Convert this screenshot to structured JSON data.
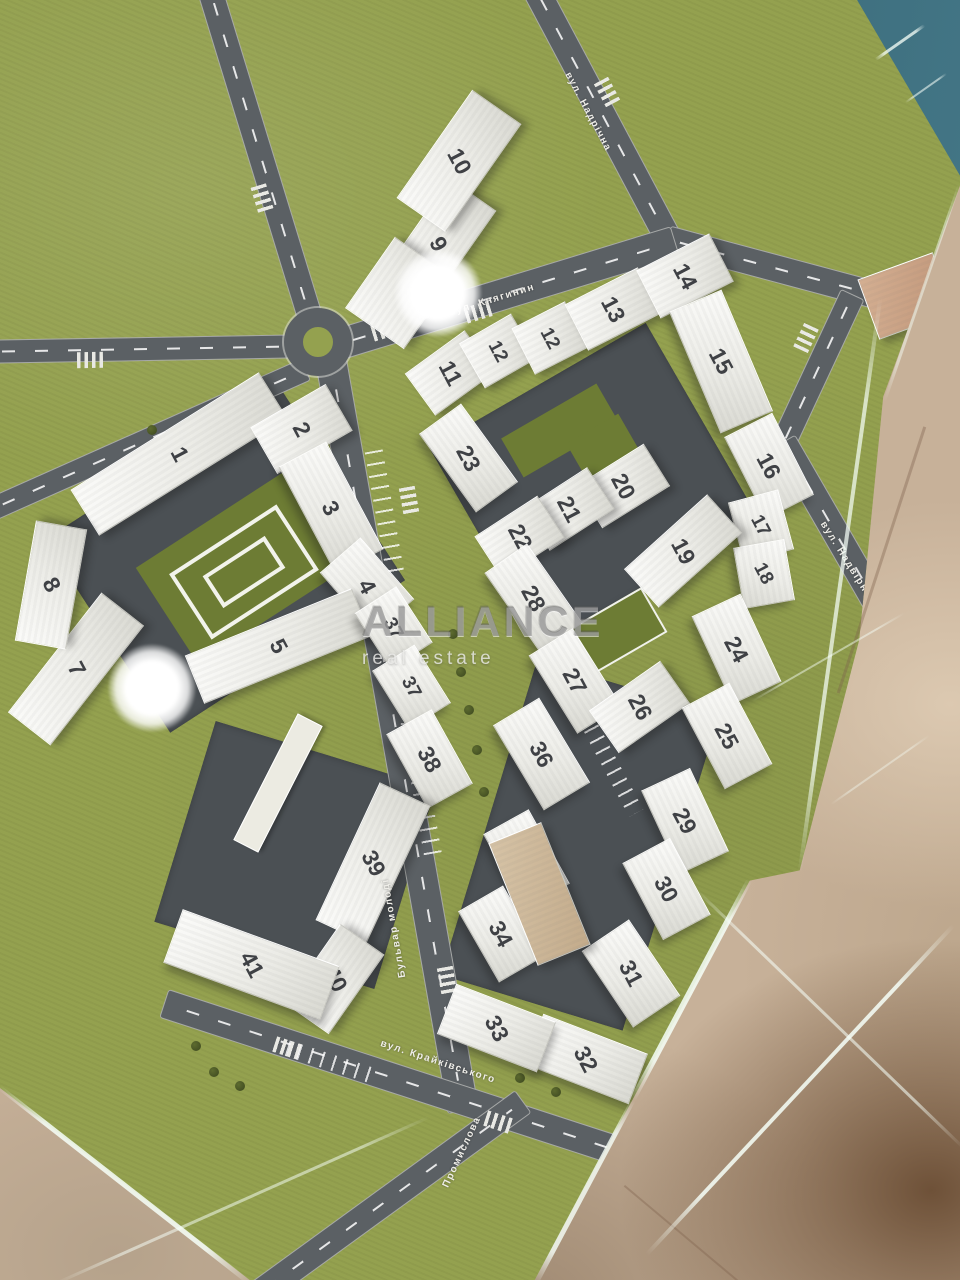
{
  "watermark": {
    "line1": "ALLIANCE",
    "line2": "real estate"
  },
  "colors": {
    "grass": "#94a14f",
    "road": "#5b6064",
    "courtyard": "#4b5054",
    "water": "#33616f",
    "marble": "#c7b199",
    "roof_green": "#6d7c34",
    "building": "#f2f1ec",
    "number": "#3f4145"
  },
  "streets": [
    {
      "name": "вул. Надрічна",
      "x": 588,
      "y": 112,
      "rot": 62
    },
    {
      "name": "вул. Княгинин",
      "x": 492,
      "y": 300,
      "rot": -17
    },
    {
      "name": "вул. Надвірна",
      "x": 846,
      "y": 560,
      "rot": 58
    },
    {
      "name": "Бульвар молоді",
      "x": 394,
      "y": 928,
      "rot": -100
    },
    {
      "name": "вул. Крайківського",
      "x": 438,
      "y": 1062,
      "rot": 18
    },
    {
      "name": "Промислова",
      "x": 462,
      "y": 1152,
      "rot": -65
    }
  ],
  "courts": [
    {
      "x": 225,
      "y": 560,
      "w": 280,
      "h": 230,
      "r": -33
    },
    {
      "x": 295,
      "y": 855,
      "w": 230,
      "h": 210,
      "r": 17
    },
    {
      "x": 595,
      "y": 485,
      "w": 250,
      "h": 230,
      "r": -30
    },
    {
      "x": 580,
      "y": 845,
      "w": 190,
      "h": 330,
      "r": 17
    }
  ],
  "roads": [
    {
      "x": 601,
      "y": 114,
      "len": 285,
      "w": 26,
      "rot": 62
    },
    {
      "x": 814,
      "y": 278,
      "len": 305,
      "w": 26,
      "rot": 15
    },
    {
      "x": 506,
      "y": 292,
      "len": 350,
      "w": 30,
      "rot": -17
    },
    {
      "x": 260,
      "y": 156,
      "len": 350,
      "w": 24,
      "rot": 73
    },
    {
      "x": 145,
      "y": 348,
      "len": 312,
      "w": 22,
      "rot": -1
    },
    {
      "x": 146,
      "y": 439,
      "len": 345,
      "w": 22,
      "rot": -24
    },
    {
      "x": 396,
      "y": 734,
      "len": 762,
      "w": 30,
      "rot": 80
    },
    {
      "x": 432,
      "y": 1090,
      "len": 565,
      "w": 28,
      "rot": 18
    },
    {
      "x": 388,
      "y": 1198,
      "len": 330,
      "w": 26,
      "rot": -36
    },
    {
      "x": 816,
      "y": 369,
      "len": 165,
      "w": 24,
      "rot": -65
    },
    {
      "x": 859,
      "y": 574,
      "len": 306,
      "w": 26,
      "rot": 60
    }
  ],
  "crosswalks": [
    {
      "x": 607,
      "y": 92,
      "rot": 62
    },
    {
      "x": 478,
      "y": 312,
      "rot": -17
    },
    {
      "x": 385,
      "y": 330,
      "rot": -17
    },
    {
      "x": 262,
      "y": 198,
      "rot": 73
    },
    {
      "x": 409,
      "y": 500,
      "rot": 80
    },
    {
      "x": 447,
      "y": 980,
      "rot": 80
    },
    {
      "x": 498,
      "y": 1122,
      "rot": 18
    },
    {
      "x": 287,
      "y": 1048,
      "rot": 18
    },
    {
      "x": 806,
      "y": 338,
      "rot": -65
    },
    {
      "x": 90,
      "y": 360,
      "rot": -1
    }
  ],
  "parking": [
    {
      "x": 385,
      "y": 515,
      "len": 130,
      "w": 18,
      "rot": 80
    },
    {
      "x": 418,
      "y": 770,
      "len": 170,
      "w": 18,
      "rot": 80
    },
    {
      "x": 330,
      "y": 1062,
      "len": 90,
      "w": 16,
      "rot": 18
    },
    {
      "x": 608,
      "y": 760,
      "len": 120,
      "w": 16,
      "rot": 62
    }
  ],
  "features": [
    {
      "t": "green",
      "x": 240,
      "y": 568,
      "w": 175,
      "h": 115,
      "r": -33
    },
    {
      "t": "ring",
      "x": 240,
      "y": 568,
      "w": 120,
      "h": 70,
      "r": -33
    },
    {
      "t": "ring",
      "x": 240,
      "y": 568,
      "w": 66,
      "h": 30,
      "r": -33
    },
    {
      "t": "green",
      "x": 560,
      "y": 430,
      "w": 110,
      "h": 45,
      "r": -30
    },
    {
      "t": "green",
      "x": 606,
      "y": 452,
      "w": 60,
      "h": 55,
      "r": -30
    },
    {
      "t": "green",
      "x": 617,
      "y": 628,
      "w": 78,
      "h": 48,
      "r": -30,
      "b": 1
    },
    {
      "t": "white",
      "x": 277,
      "y": 782,
      "w": 140,
      "h": 26,
      "r": -63
    }
  ],
  "trees": [
    [
      453,
      634
    ],
    [
      461,
      672
    ],
    [
      469,
      710
    ],
    [
      477,
      750
    ],
    [
      484,
      792
    ],
    [
      300,
      420
    ],
    [
      268,
      430
    ],
    [
      152,
      430
    ],
    [
      172,
      436
    ],
    [
      196,
      1046
    ],
    [
      214,
      1072
    ],
    [
      240,
      1086
    ],
    [
      520,
      1078
    ],
    [
      556,
      1092
    ]
  ],
  "buildings": [
    {
      "n": "1",
      "x": 178,
      "y": 453,
      "w": 220,
      "h": 52,
      "r": -32
    },
    {
      "n": "2",
      "x": 300,
      "y": 428,
      "w": 85,
      "h": 52,
      "r": -30
    },
    {
      "n": "3",
      "x": 330,
      "y": 507,
      "w": 120,
      "h": 52,
      "r": 62
    },
    {
      "n": "4",
      "x": 366,
      "y": 585,
      "w": 80,
      "h": 52,
      "r": 49
    },
    {
      "n": "5",
      "x": 277,
      "y": 645,
      "w": 178,
      "h": 50,
      "r": -22
    },
    {
      "n": "7",
      "x": 75,
      "y": 668,
      "w": 150,
      "h": 52,
      "r": -52
    },
    {
      "n": "8",
      "x": 50,
      "y": 584,
      "w": 120,
      "h": 50,
      "r": -80
    },
    {
      "n": "9",
      "x": 437,
      "y": 243,
      "w": 120,
      "h": 55,
      "r": -55
    },
    {
      "n": "10",
      "x": 458,
      "y": 160,
      "w": 130,
      "h": 58,
      "r": -55
    },
    {
      "x": 398,
      "y": 292,
      "w": 85,
      "h": 70,
      "r": -55
    },
    {
      "n": "11",
      "x": 449,
      "y": 372,
      "w": 72,
      "h": 50,
      "r": -36
    },
    {
      "n": "12",
      "x": 497,
      "y": 350,
      "w": 58,
      "h": 50,
      "r": -30
    },
    {
      "n": "12",
      "x": 549,
      "y": 337,
      "w": 58,
      "h": 50,
      "r": -27
    },
    {
      "n": "13",
      "x": 612,
      "y": 308,
      "w": 80,
      "h": 50,
      "r": -27
    },
    {
      "n": "14",
      "x": 684,
      "y": 275,
      "w": 80,
      "h": 52,
      "r": -27
    },
    {
      "n": "15",
      "x": 720,
      "y": 360,
      "w": 130,
      "h": 55,
      "r": 67
    },
    {
      "n": "16",
      "x": 768,
      "y": 465,
      "w": 90,
      "h": 52,
      "r": 63
    },
    {
      "n": "17",
      "x": 760,
      "y": 525,
      "w": 60,
      "h": 50,
      "r": 75
    },
    {
      "n": "18",
      "x": 763,
      "y": 573,
      "w": 60,
      "h": 50,
      "r": 80
    },
    {
      "n": "19",
      "x": 682,
      "y": 550,
      "w": 110,
      "h": 50,
      "r": -42
    },
    {
      "n": "20",
      "x": 622,
      "y": 485,
      "w": 78,
      "h": 48,
      "r": -32
    },
    {
      "n": "21",
      "x": 567,
      "y": 508,
      "w": 75,
      "h": 48,
      "r": -33
    },
    {
      "n": "22",
      "x": 518,
      "y": 536,
      "w": 73,
      "h": 48,
      "r": -33
    },
    {
      "n": "23",
      "x": 467,
      "y": 457,
      "w": 95,
      "h": 50,
      "r": 54
    },
    {
      "n": "28",
      "x": 532,
      "y": 597,
      "w": 95,
      "h": 50,
      "r": 55
    },
    {
      "n": "27",
      "x": 574,
      "y": 680,
      "w": 90,
      "h": 50,
      "r": 58
    },
    {
      "n": "26",
      "x": 638,
      "y": 706,
      "w": 85,
      "h": 50,
      "r": -35
    },
    {
      "n": "24",
      "x": 735,
      "y": 648,
      "w": 95,
      "h": 52,
      "r": 65
    },
    {
      "n": "25",
      "x": 726,
      "y": 735,
      "w": 90,
      "h": 52,
      "r": 62
    },
    {
      "n": "29",
      "x": 684,
      "y": 820,
      "w": 90,
      "h": 52,
      "r": 65
    },
    {
      "n": "30",
      "x": 665,
      "y": 888,
      "w": 85,
      "h": 52,
      "r": 62
    },
    {
      "n": "31",
      "x": 630,
      "y": 972,
      "w": 90,
      "h": 55,
      "r": 56
    },
    {
      "n": "32",
      "x": 585,
      "y": 1058,
      "w": 110,
      "h": 52,
      "r": 21
    },
    {
      "n": "33",
      "x": 495,
      "y": 1027,
      "w": 105,
      "h": 52,
      "r": 21
    },
    {
      "n": "36",
      "x": 540,
      "y": 753,
      "w": 97,
      "h": 52,
      "r": 59
    },
    {
      "n": "35",
      "x": 525,
      "y": 858,
      "w": 83,
      "h": 50,
      "r": 61
    },
    {
      "n": "34",
      "x": 500,
      "y": 933,
      "w": 80,
      "h": 50,
      "r": 60
    },
    {
      "x": 538,
      "y": 893,
      "w": 55,
      "h": 130,
      "r": -22,
      "c": "beige"
    },
    {
      "n": "37",
      "x": 392,
      "y": 627,
      "w": 65,
      "h": 48,
      "r": 57
    },
    {
      "n": "37",
      "x": 410,
      "y": 686,
      "w": 67,
      "h": 48,
      "r": 58
    },
    {
      "n": "38",
      "x": 428,
      "y": 758,
      "w": 83,
      "h": 50,
      "r": 61
    },
    {
      "n": "39",
      "x": 372,
      "y": 862,
      "w": 150,
      "h": 54,
      "r": -65
    },
    {
      "n": "40",
      "x": 333,
      "y": 978,
      "w": 95,
      "h": 52,
      "r": -55
    },
    {
      "n": "41",
      "x": 250,
      "y": 963,
      "w": 165,
      "h": 55,
      "r": 20
    },
    {
      "x": 905,
      "y": 295,
      "w": 78,
      "h": 62,
      "r": -20,
      "c": "tan"
    }
  ],
  "streaks": [
    {
      "x": 840,
      "y": 585,
      "len": 580,
      "w": 4,
      "rot": 98,
      "o": 0.75
    },
    {
      "x": 691,
      "y": 990,
      "len": 250,
      "w": 6,
      "rot": 118,
      "o": 0.9
    },
    {
      "x": 584,
      "y": 1192,
      "len": 210,
      "w": 5,
      "rot": 118,
      "o": 0.85
    },
    {
      "x": 125,
      "y": 1185,
      "len": 320,
      "w": 5,
      "rot": 38,
      "o": 0.9
    },
    {
      "x": 242,
      "y": 1200,
      "len": 410,
      "w": 3,
      "rot": -24,
      "o": 0.55
    },
    {
      "x": 800,
      "y": 1090,
      "len": 450,
      "w": 4,
      "rot": -47,
      "o": 0.9
    },
    {
      "x": 829,
      "y": 1018,
      "len": 375,
      "w": 3,
      "rot": 44,
      "o": 0.6
    },
    {
      "x": 828,
      "y": 657,
      "len": 175,
      "w": 2,
      "rot": -30,
      "o": 0.5
    },
    {
      "x": 880,
      "y": 770,
      "len": 120,
      "w": 2,
      "rot": -35,
      "o": 0.4
    },
    {
      "x": 900,
      "y": 42,
      "len": 60,
      "w": 3,
      "rot": -35,
      "o": 0.8
    },
    {
      "x": 926,
      "y": 88,
      "len": 50,
      "w": 2,
      "rot": -35,
      "o": 0.6
    },
    {
      "x": 922,
      "y": 292,
      "len": 230,
      "w": 3,
      "rot": -71,
      "o": 0.5
    }
  ],
  "lights": [
    {
      "x": 438,
      "y": 293,
      "d": 88
    },
    {
      "x": 152,
      "y": 688,
      "d": 88
    }
  ]
}
